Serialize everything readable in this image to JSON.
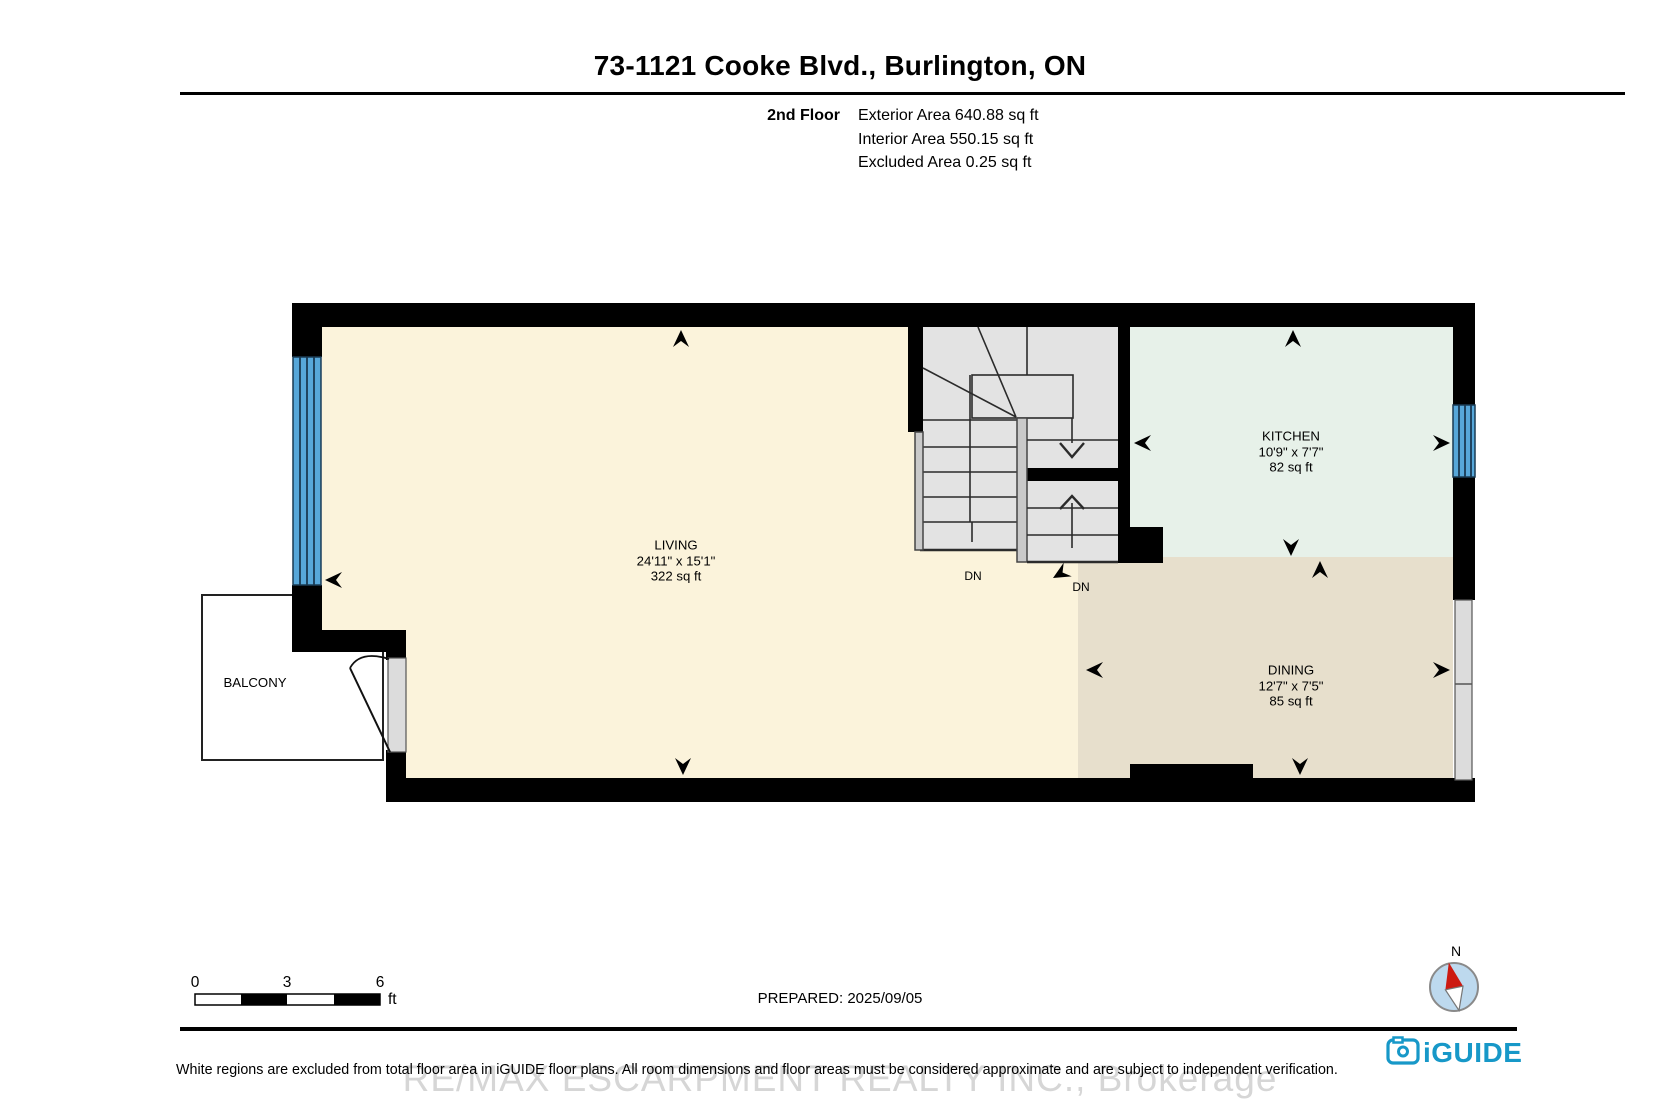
{
  "header": {
    "title": "73-1121 Cooke Blvd., Burlington, ON",
    "floor_label": "2nd Floor",
    "area_lines": {
      "exterior": "Exterior Area 640.88 sq ft",
      "interior": "Interior Area 550.15 sq ft",
      "excluded": "Excluded Area 0.25 sq ft"
    }
  },
  "rooms": {
    "living": {
      "name": "LIVING",
      "dimensions": "24'11\" x 15'1\"",
      "area": "322 sq ft"
    },
    "kitchen": {
      "name": "KITCHEN",
      "dimensions": "10'9\" x 7'7\"",
      "area": "82 sq ft"
    },
    "dining": {
      "name": "DINING",
      "dimensions": "12'7\" x 7'5\"",
      "area": "85 sq ft"
    },
    "balcony": {
      "name": "BALCONY"
    }
  },
  "stairs": {
    "dn_left": "DN",
    "dn_right": "DN"
  },
  "scale_bar": {
    "tick_0": "0",
    "tick_3": "3",
    "tick_6": "6",
    "unit": "ft"
  },
  "footer": {
    "prepared": "PREPARED: 2025/09/05",
    "disclaimer": "White regions are excluded from total floor area in iGUIDE floor plans. All room dimensions and floor areas must be considered approximate and are subject to independent verification.",
    "watermark": "RE/MAX ESCARPMENT REALTY INC., Brokerage",
    "compass_north": "N",
    "brand": "iGUIDE"
  },
  "colors": {
    "wall": "#000000",
    "living": "#FBF3DB",
    "kitchen": "#E7F1E9",
    "dining": "#E7DFCC",
    "stairs": "#E3E3E3",
    "window_blue": "#57A7D9",
    "brand_teal": "#1798C8",
    "compass_blue": "#BDD9EE",
    "needle_red": "#CC1A11",
    "watermark_gray": "#D6D6D6"
  }
}
